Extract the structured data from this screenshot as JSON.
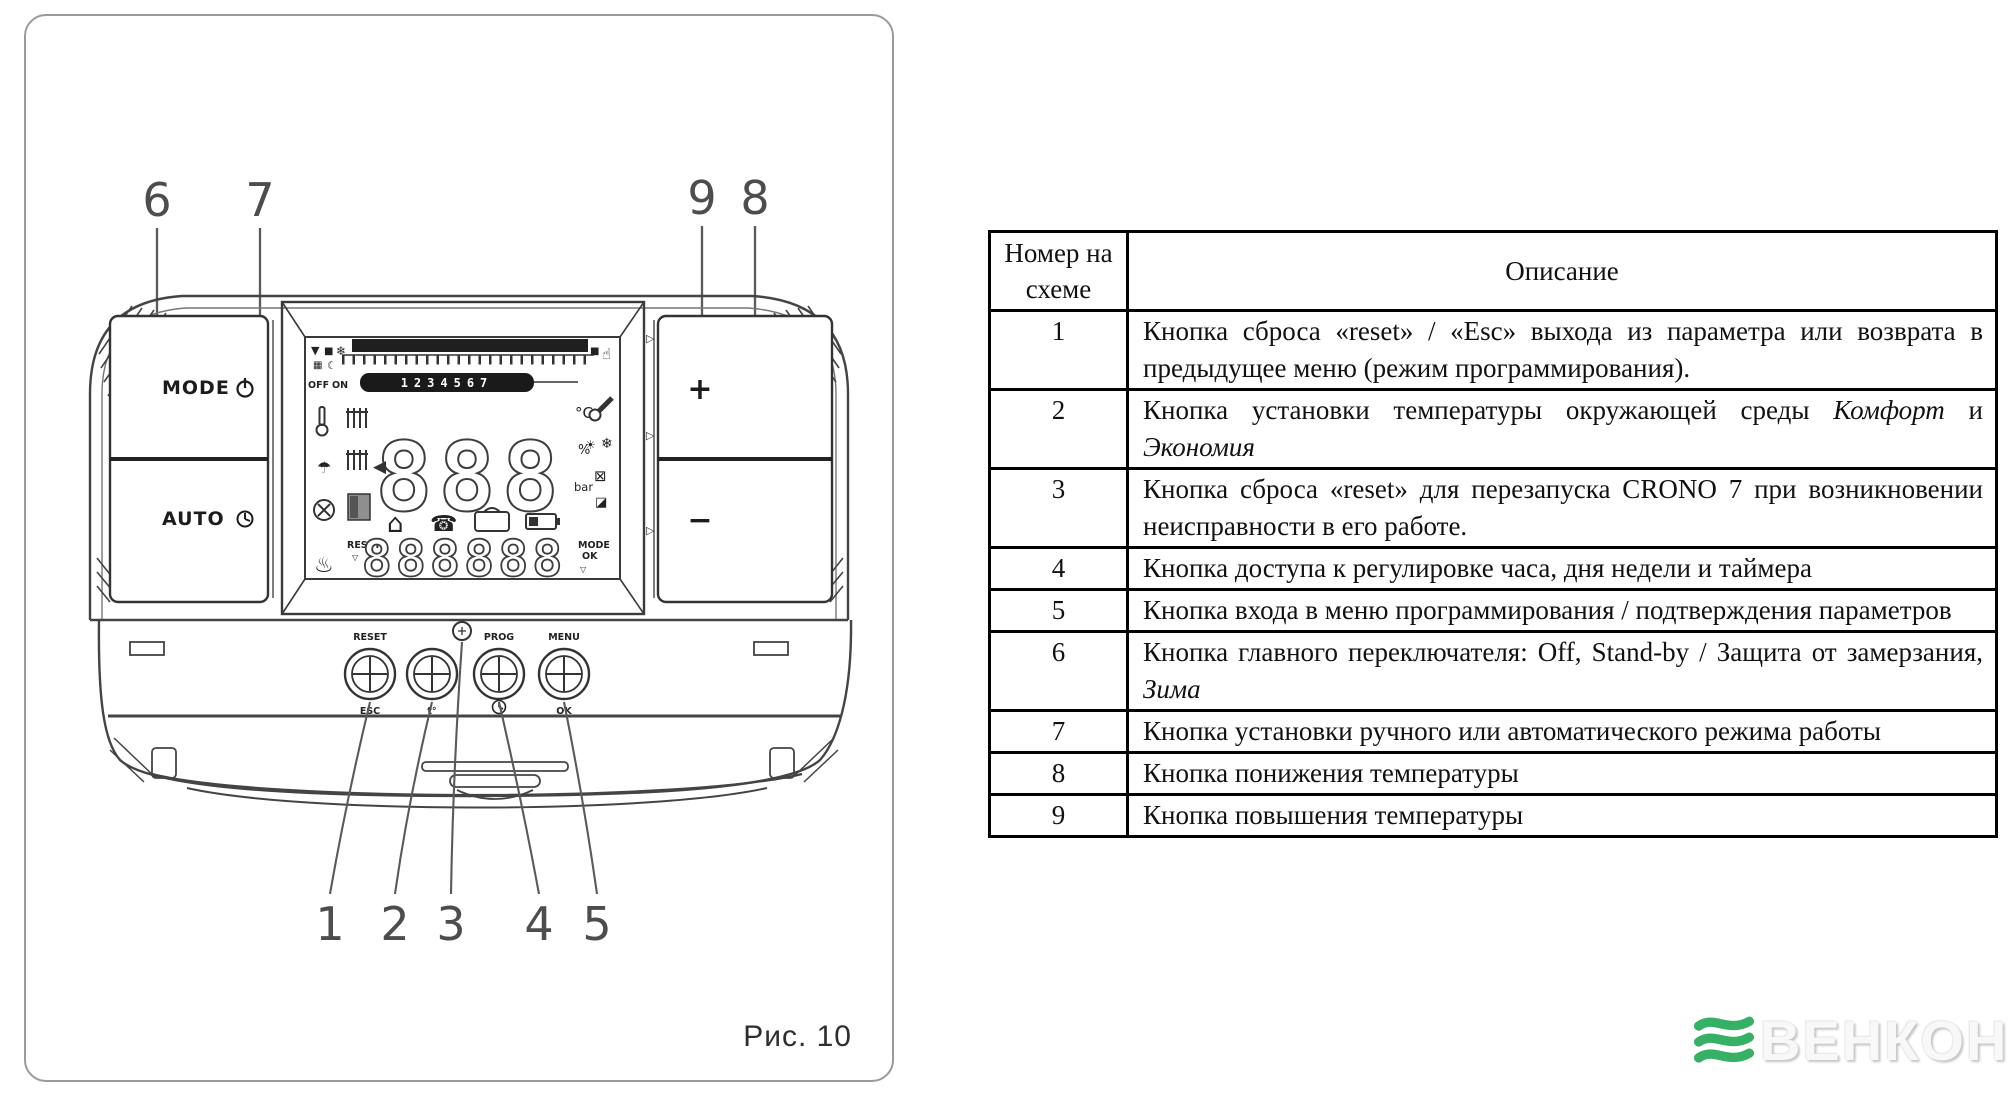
{
  "figure": {
    "caption": "Рис. 10",
    "callouts": {
      "c1": "1",
      "c2": "2",
      "c3": "3",
      "c4": "4",
      "c5": "5",
      "c6": "6",
      "c7": "7",
      "c8": "8",
      "c9": "9"
    },
    "device": {
      "buttons": {
        "mode": "MODE",
        "auto": "AUTO",
        "plus": "+",
        "minus": "−",
        "round1_top": "RESET",
        "round1_bottom": "ESC",
        "round2_bottom": "t°",
        "round3_top": "PROG",
        "round4_top": "MENU",
        "round4_bottom": "OK"
      },
      "lcd": {
        "days": "1234567",
        "big_digits": "888",
        "small_digits": "888888",
        "off": "OFF",
        "on": "ON",
        "unit_temp": "°C",
        "unit_percent": "%",
        "unit_bar": "bar",
        "reset_label": "RESET",
        "mode_label": "MODE",
        "ok_label": "OK",
        "icons": {
          "triangle_down": "▼",
          "square": "■",
          "snowflake": "❄",
          "grid": "▦",
          "moon": "☾",
          "hand": "☝",
          "arrow_left": "◀",
          "house": "⌂",
          "phone": "☎",
          "shower": "☂",
          "heat": "♨",
          "sun": "☀",
          "box_x": "⊠",
          "half_square": "◪",
          "marker_down": "▽",
          "marker_right": "▷"
        }
      }
    }
  },
  "table": {
    "headers": [
      "Номер на схеме",
      "Описание"
    ],
    "rows": [
      {
        "num": "1",
        "desc": [
          {
            "t": "Кнопка сброса «reset» / «Esc» выхода из параметра или возврата в предыдущее меню (режим программирования).",
            "i": false
          }
        ]
      },
      {
        "num": "2",
        "desc": [
          {
            "t": "Кнопка установки температуры окружающей среды ",
            "i": false
          },
          {
            "t": "Комфорт",
            "i": true
          },
          {
            "t": " и ",
            "i": false
          },
          {
            "t": "Экономия",
            "i": true
          }
        ]
      },
      {
        "num": "3",
        "desc": [
          {
            "t": "Кнопка сброса «reset» для перезапуска CRONO 7 при возникновении неисправности в его работе.",
            "i": false
          }
        ]
      },
      {
        "num": "4",
        "desc": [
          {
            "t": "Кнопка доступа к регулировке часа, дня недели и таймера",
            "i": false
          }
        ]
      },
      {
        "num": "5",
        "desc": [
          {
            "t": "Кнопка входа в меню программирования / подтверждения параметров",
            "i": false
          }
        ]
      },
      {
        "num": "6",
        "desc": [
          {
            "t": "Кнопка главного переключателя: Off, Stand-by / Защита от замерзания, ",
            "i": false
          },
          {
            "t": "Зима",
            "i": true
          }
        ]
      },
      {
        "num": "7",
        "desc": [
          {
            "t": "Кнопка установки ручного или автоматического режима работы",
            "i": false
          }
        ]
      },
      {
        "num": "8",
        "desc": [
          {
            "t": "Кнопка понижения температуры",
            "i": false
          }
        ]
      },
      {
        "num": "9",
        "desc": [
          {
            "t": "Кнопка повышения температуры",
            "i": false
          }
        ]
      }
    ]
  },
  "logo": {
    "text": "ВЕНКОН",
    "wave_color": "#35b065",
    "text_color": "#f8f8f8"
  }
}
